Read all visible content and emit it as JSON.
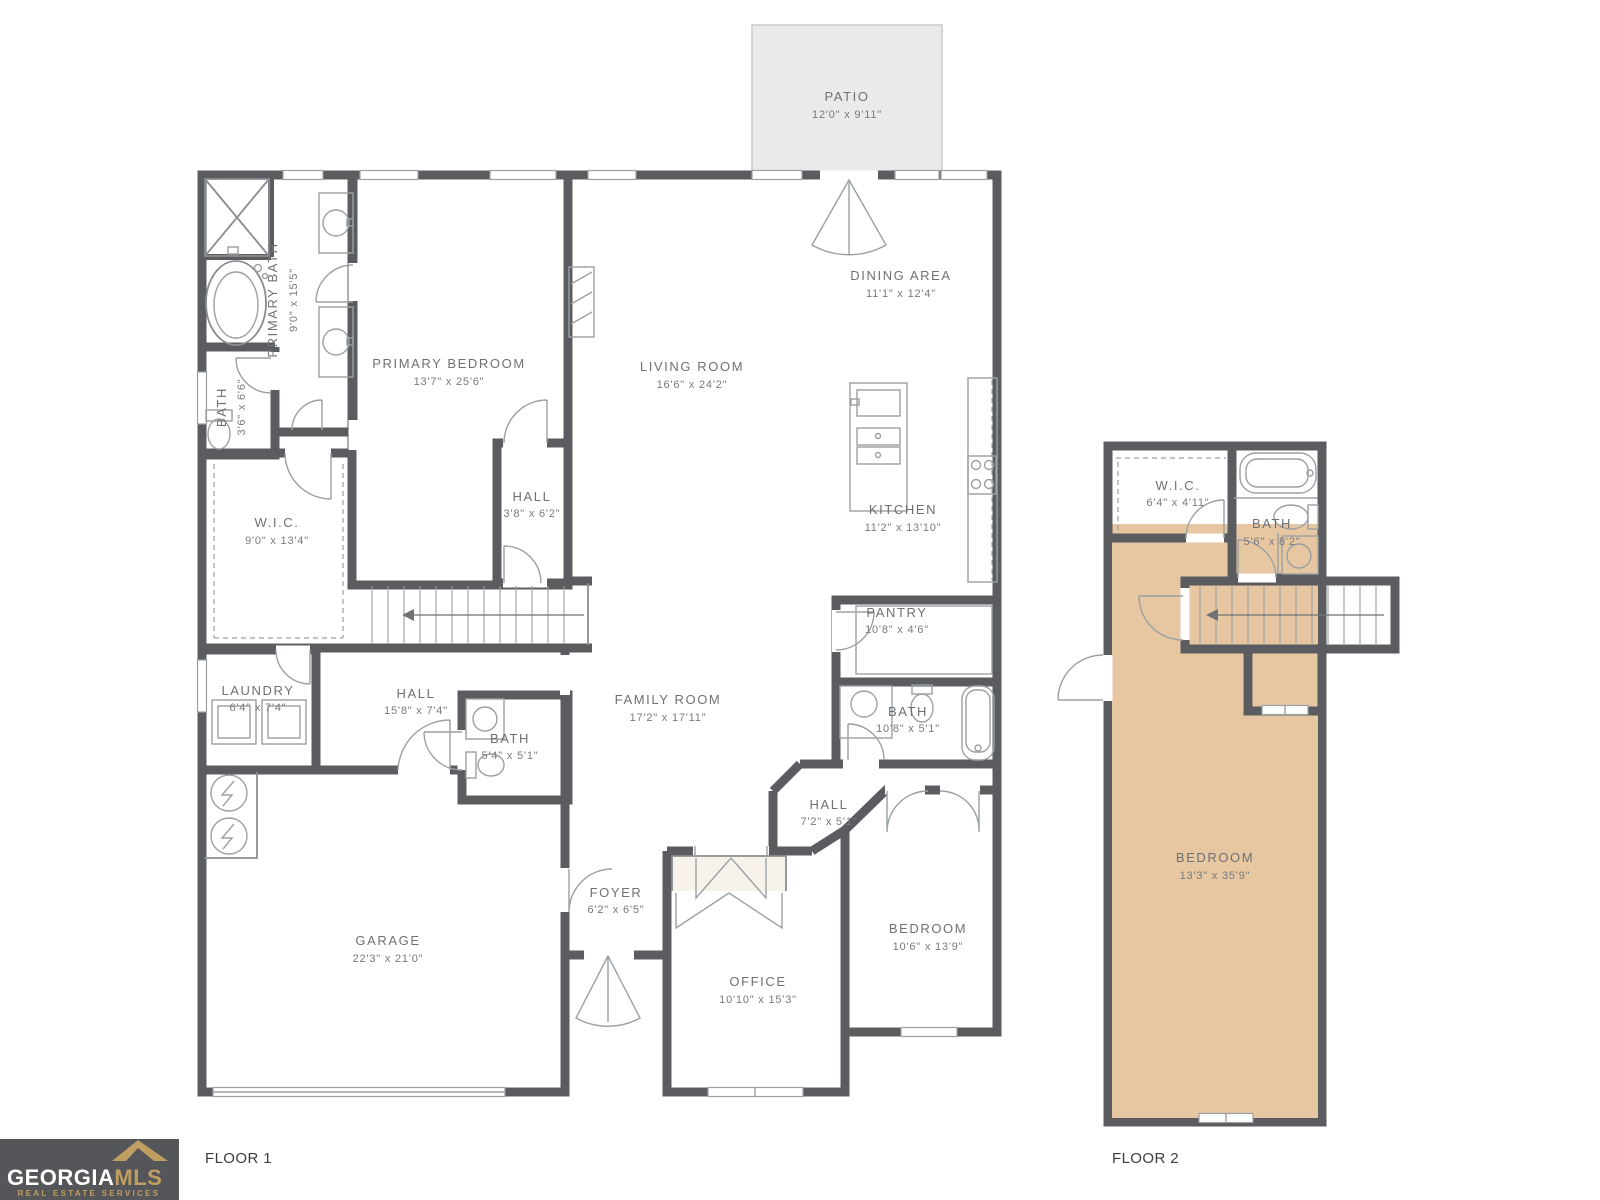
{
  "colors": {
    "wall": "#5a5c60",
    "floor_common": "#f1ece2",
    "floor_bedroom": "#e7c6a2",
    "floor_bath": "#cfe1e4",
    "patio_fill": "#eaeaed",
    "patio_edge": "#c9cacd",
    "tub_fill": "#dfecee",
    "closet_fill": "#f7f3ea",
    "label_text": "#6e7174",
    "footer_text": "#3d3d3d",
    "logo_bg": "#55565a",
    "logo_gold": "#bf9e62",
    "logo_white": "#ffffff"
  },
  "patio": {
    "name": "PATIO",
    "dims": "12'0\" x 9'11\""
  },
  "floor1": {
    "primary_bath": {
      "name": "PRIMARY BATH",
      "dims": "9'0\" x 15'5\""
    },
    "bath_small": {
      "name": "BATH",
      "dims": "3'6\" x 6'6\""
    },
    "primary_bedroom": {
      "name": "PRIMARY BEDROOM",
      "dims": "13'7\" x 25'6\""
    },
    "wic": {
      "name": "W.I.C.",
      "dims": "9'0\" x 13'4\""
    },
    "hall_a": {
      "name": "HALL",
      "dims": "3'8\" x 6'2\""
    },
    "living_room": {
      "name": "LIVING ROOM",
      "dims": "16'6\" x 24'2\""
    },
    "dining_area": {
      "name": "DINING AREA",
      "dims": "11'1\" x 12'4\""
    },
    "kitchen": {
      "name": "KITCHEN",
      "dims": "11'2\" x 13'10\""
    },
    "pantry": {
      "name": "PANTRY",
      "dims": "10'8\" x 4'6\""
    },
    "bath_hall": {
      "name": "BATH",
      "dims": "10'8\" x 5'1\""
    },
    "laundry": {
      "name": "LAUNDRY",
      "dims": "6'4\" x 7'4\""
    },
    "hall_b": {
      "name": "HALL",
      "dims": "15'8\" x 7'4\""
    },
    "bath_c": {
      "name": "BATH",
      "dims": "5'4\" x 5'1\""
    },
    "family_room": {
      "name": "FAMILY ROOM",
      "dims": "17'2\" x 17'11\""
    },
    "hall_c": {
      "name": "HALL",
      "dims": "7'2\" x 5'1\""
    },
    "foyer": {
      "name": "FOYER",
      "dims": "6'2\" x 6'5\""
    },
    "garage": {
      "name": "GARAGE",
      "dims": "22'3\" x 21'0\""
    },
    "office": {
      "name": "OFFICE",
      "dims": "10'10\" x 15'3\""
    },
    "bedroom": {
      "name": "BEDROOM",
      "dims": "10'6\" x 13'9\""
    }
  },
  "floor2": {
    "wic": {
      "name": "W.I.C.",
      "dims": "6'4\" x 4'11\""
    },
    "bath": {
      "name": "BATH",
      "dims": "5'6\" x 8'2\""
    },
    "bedroom": {
      "name": "BEDROOM",
      "dims": "13'3\" x 35'9\""
    }
  },
  "footer": {
    "floor1_label": "FLOOR 1",
    "floor2_label": "FLOOR 2"
  },
  "logo": {
    "text_primary": "GEORGIA",
    "text_secondary": "MLS",
    "subtext": "REAL ESTATE SERVICES"
  }
}
